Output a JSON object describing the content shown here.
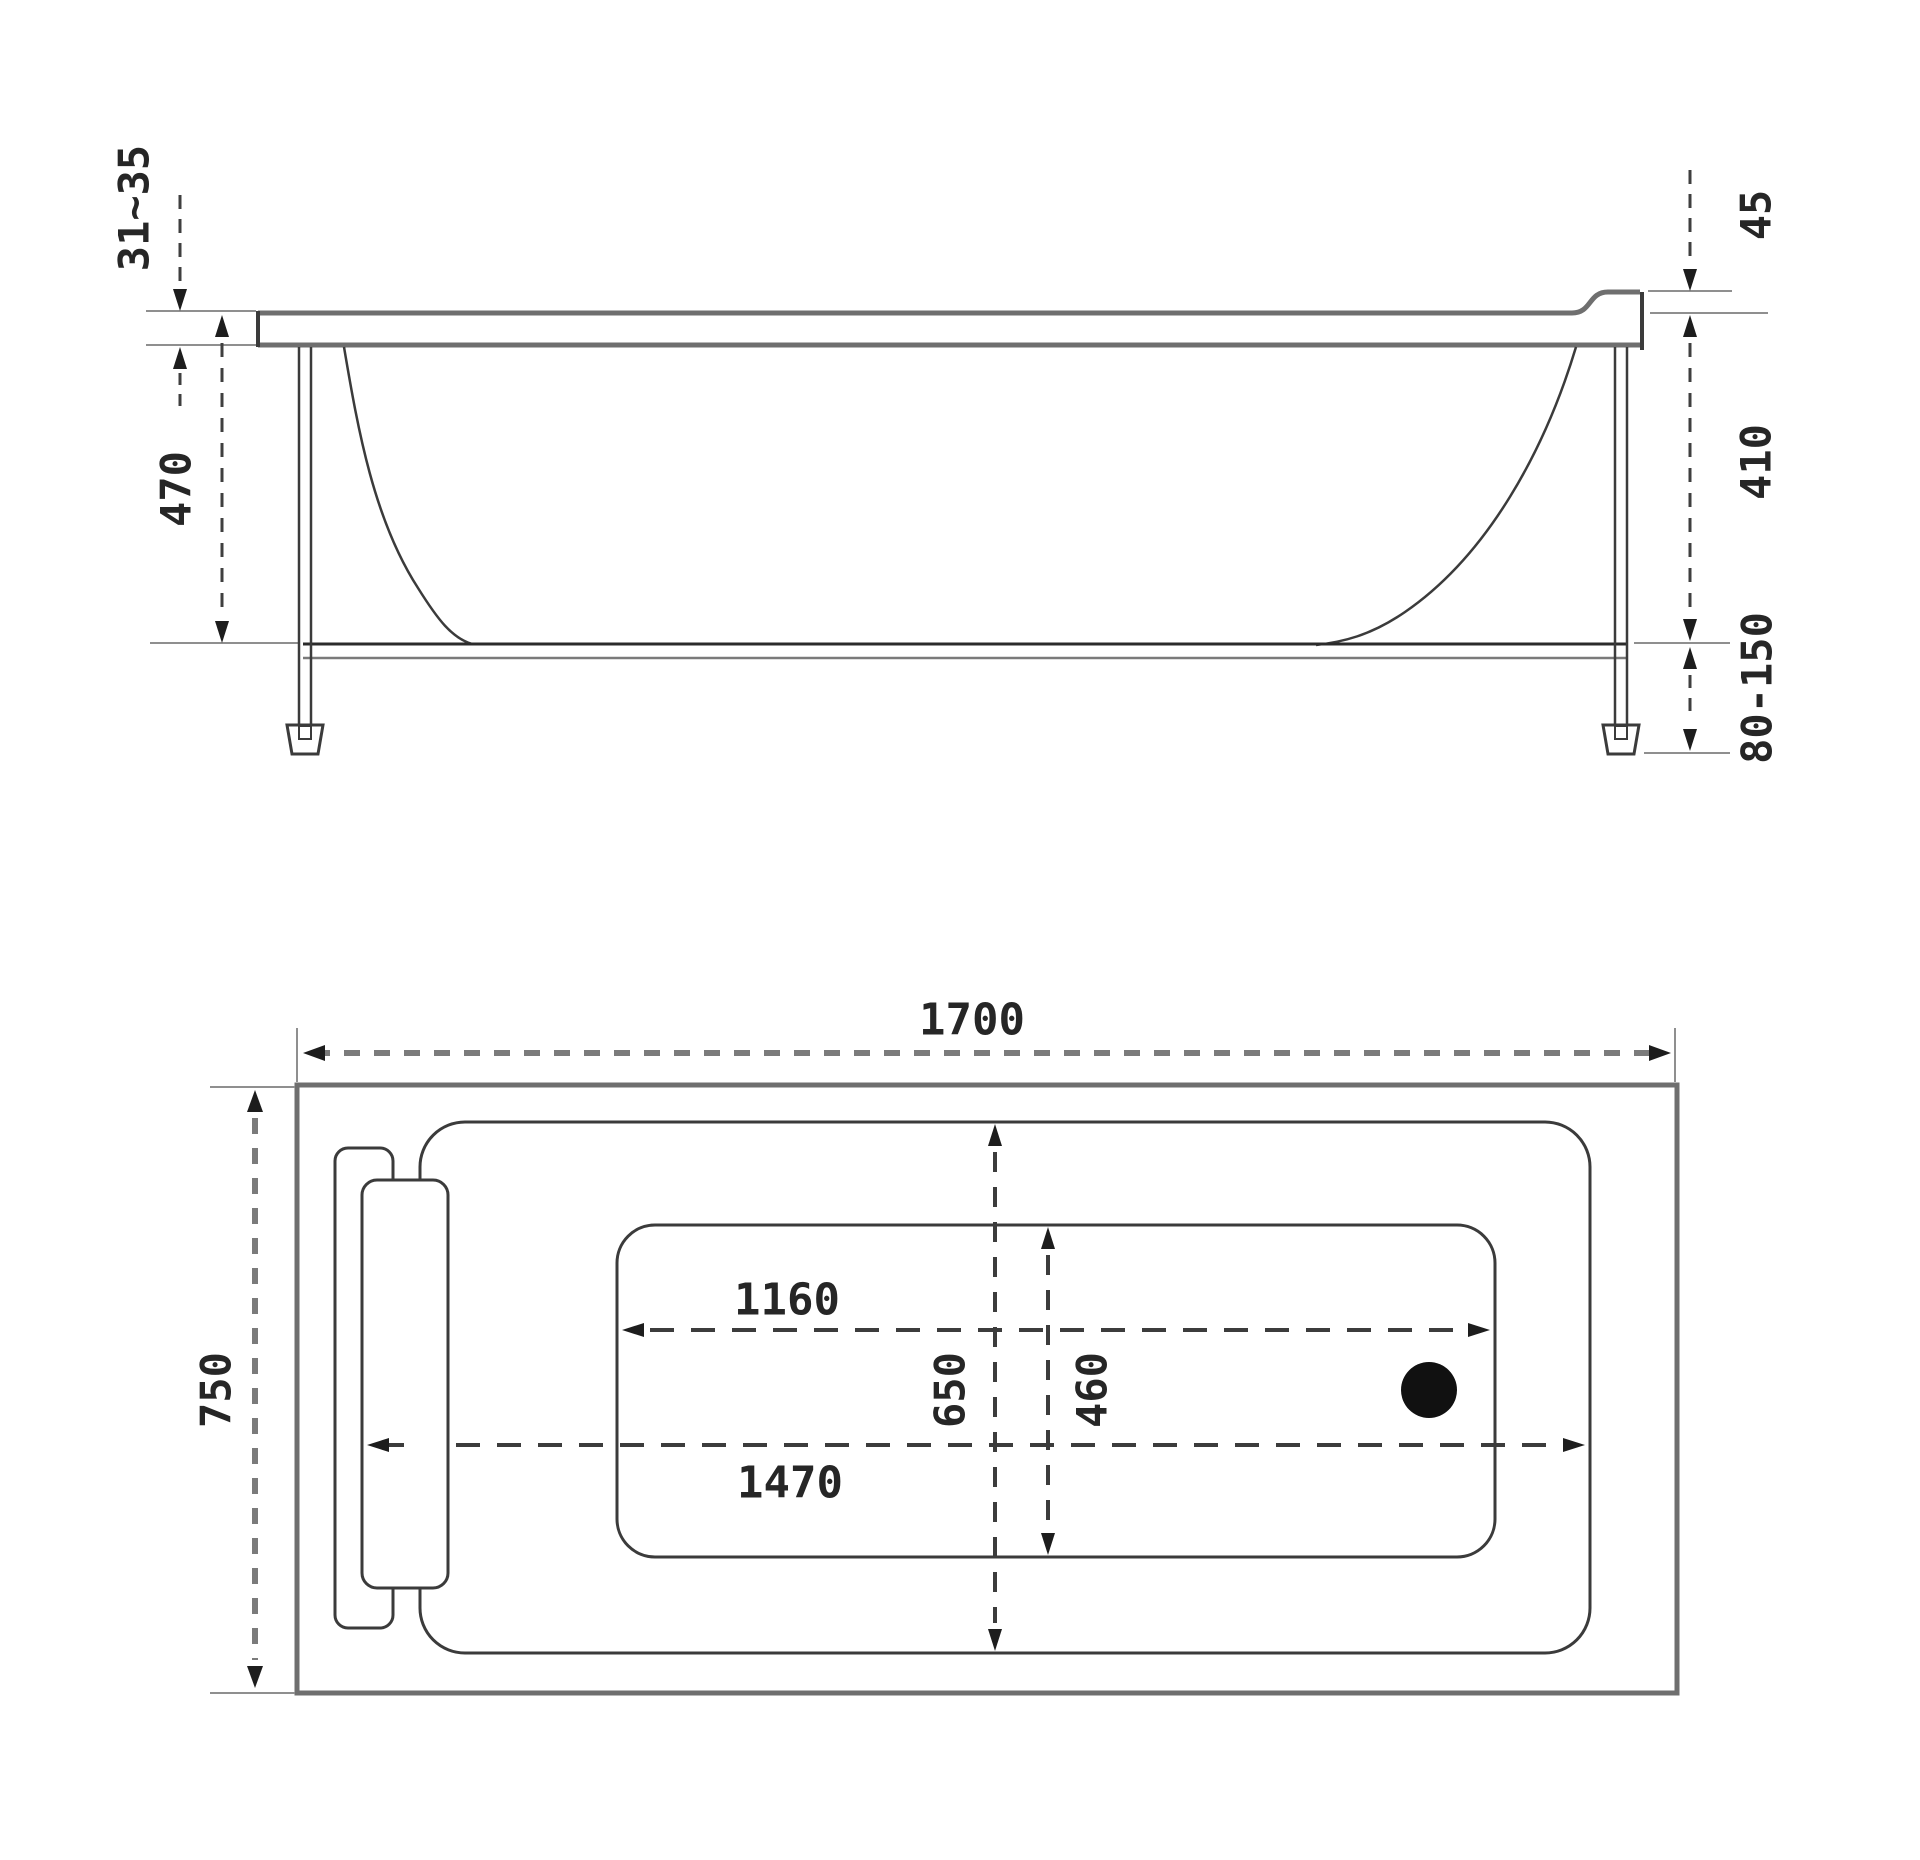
{
  "diagram": {
    "kind": "bathtub-installation-technical-drawing",
    "side_view": {
      "dims": {
        "rim_thickness": "31~35",
        "height_rim_to_bottom": "470",
        "headrest_ledge_height": "45",
        "inner_depth": "410",
        "adjustable_feet_height": "80-150"
      }
    },
    "plan_view": {
      "dims": {
        "overall_length": "1700",
        "overall_width": "750",
        "bottom_length": "1160",
        "inner_width": "650",
        "bottom_width": "460",
        "inner_length": "1470"
      }
    },
    "colors": {
      "line_primary": "#3b3b3b",
      "line_secondary": "#6f6f6f",
      "line_extension": "#8f8f8f",
      "dimension_text": "#262626",
      "drain": "#111111",
      "background": "#ffffff"
    }
  }
}
